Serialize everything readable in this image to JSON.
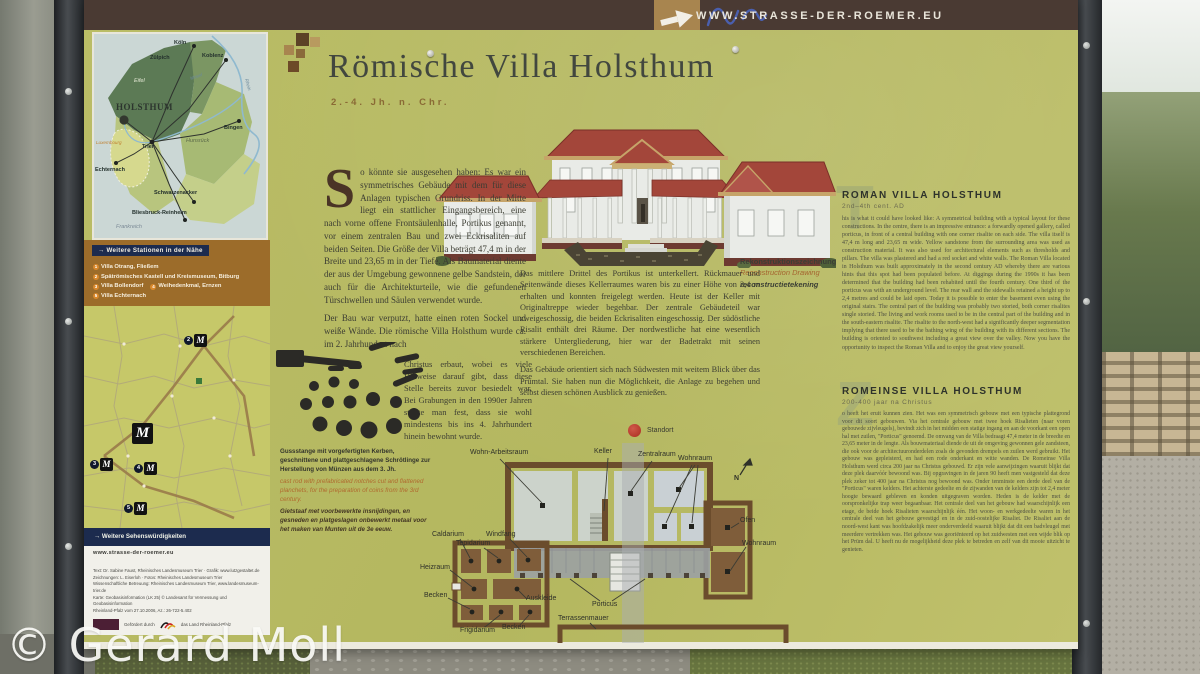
{
  "photo": {
    "watermark": "© Gerard Moll"
  },
  "colors": {
    "board_olive": "#b7ba63",
    "topbar_brown": "#4a3a33",
    "stations_brown": "#9c6c2a",
    "navy": "#1c2b4e",
    "roof_red": "#a3463a",
    "standort_red": "#bf3a2a"
  },
  "topbar": {
    "url": "WWW.STRASSE-DER-ROEMER.EU"
  },
  "header": {
    "title": "Römische Villa Holsthum",
    "subtitle": "2.-4. Jh. n. Chr."
  },
  "overview_map": {
    "holsthum": "HOLSTHUM",
    "cities": [
      {
        "label": "Köln"
      },
      {
        "label": "Zülpich"
      },
      {
        "label": "Koblenz"
      },
      {
        "label": "Bingen"
      },
      {
        "label": "Trier"
      },
      {
        "label": "Echternach"
      },
      {
        "label": "Schwarzenacker"
      },
      {
        "label": "Bliesbruck-Reinheim"
      }
    ],
    "regions": {
      "eifel": "Eifel",
      "hunsrueck": "Hunsrück",
      "frankreich": "Frankreich",
      "luxemburg": "Luxembourg",
      "mosel": "Mosel",
      "rhein": "Rhein"
    }
  },
  "stations": {
    "heading": "→ Weitere Stationen in der Nähe",
    "items": [
      {
        "num": "1",
        "label": "Villa Otrang, Fließem"
      },
      {
        "num": "2",
        "label": "Spätrömisches Kastell und Kreismuseum, Bitburg"
      },
      {
        "num": "3",
        "label": "Villa Bollendorf"
      },
      {
        "num": "4",
        "label": "Weihedenkmal, Ernzen"
      },
      {
        "num": "5",
        "label": "Villa Echternach"
      }
    ]
  },
  "sights": {
    "heading": "→ Weitere Sehenswürdigkeiten"
  },
  "credits": {
    "url": "www.strasse-der-roemer.eu",
    "lines": [
      "Text: Dr. Sabine Faust, Rheinisches Landesmuseum Trier · Grafik: www.lutzgestaltet.de",
      "Zeichnungen: L. Eiserloh · Fotos: Rheinisches Landesmuseum Trier",
      "Wissenschaftliche Betreuung: Rheinisches Landesmuseum Trier, www.landesmuseum-trier.de",
      "Karte: Geobasisinformation (LK 25) © Landesamt für Vermessung und Geobasisinformation",
      "Rheinland-Pfalz vom 27.10.2006, Az.: 26-722-5.402"
    ],
    "funding_label": "Gefördert durch",
    "funding_name": "das Land Rheinland-Pfalz"
  },
  "german": {
    "dropcap": "S",
    "para1": "o könnte sie ausgesehen haben: Es war ein symmetrisches Gebäude mit dem für diese Anlagen typischen Grundriss. In der Mitte liegt ein stattlicher Eingangsbereich, eine nach vorne offene Frontsäulenhalle, Portikus genannt, vor einem zentralen Bau und zwei Eckrisaliten auf beiden Seiten. Die Größe der Villa beträgt 47,4 m in der Breite und 23,65 m in der Tiefe. Als Baumaterial diente der aus der Umgebung gewonnene gelbe Sandstein, der auch für die Architekturteile, wie die gefundenen Türschwellen und Säulen verwendet wurde.",
    "para2": "Der Bau war verputzt, hatte einen roten Sockel und weiße Wände. Die römische Villa Holsthum wurde ca. im 2. Jahrhundert nach",
    "para2b": "Christus erbaut, wobei es viele Hinweise darauf gibt, dass diese Stelle bereits zuvor besiedelt war. Bei Grabungen in den 1990er Jahren stellte man fest, dass sie wohl mindestens bis ins 4. Jahrhundert hinein bewohnt wurde."
  },
  "middle": {
    "para1": "Das mittlere Drittel des Portikus ist unterkellert. Rückmauer und Seitenwände dieses Kellerraumes waren bis zu einer Höhe von 2,4 m erhalten und konnten freigelegt werden. Heute ist der Keller mit Originaltreppe wieder begehbar. Der zentrale Gebäudeteil war zweigeschossig, die beiden Eckrisaliten eingeschossig. Der südöstliche Risalit enthält drei Räume. Der nordwestliche hat eine wesentlich stärkere Untergliederung, hier war der Badetrakt mit seinen verschiedenen Bereichen.",
    "para2": "Das Gebäude orientiert sich nach Südwesten mit weitem Blick über das Prümtal. Sie haben nun die Möglichkeit, die Anlage zu begehen und selbst diesen schönen Ausblick zu genießen."
  },
  "reconstruction_caption": {
    "de": "Rekonstruktionszeichnung",
    "en": "Reconstruction Drawing",
    "nl": "reconstructietekening"
  },
  "artifact_caption": {
    "de": "Gussstange mit vorgefertigten Kerben, geschnittene und plattgeschlagene Schrötlinge zur Herstellung von Münzen aus dem 3. Jh.",
    "en": "cast rod with prefabricated notches cut and flattened planchets, for the preparation of coins from the 3rd century.",
    "nl": "Gietstaaf met voorbewerkte insnijdingen, en gesneden en platgeslagen onbewerkt metaal voor het maken van Munten uit de 3e eeuw."
  },
  "english": {
    "heading": "ROMAN VILLA HOLSTHUM",
    "subheading": "2nd–4th cent. AD",
    "dropcap": "T",
    "body": "his is what it could have looked like: A symmetrical building with a typical layout for these constructions. In the centre, there is an impressive entrance: a forwardly opened gallery, called porticus, in front of a central building with one corner risalite on each side. The villa itself is 47,4 m long and 23,65 m wide. Yellow sandstone from the surrounding area was used as construction material. It was also used for architectural elements such as thresholds and pillars. The villa was plastered and had a red socket and white walls. The Roman Villa located in Holsthum was built approximately in the second century AD whereby there are various hints that this spot had been populated before. At diggings during the 1990s it has been determined that the building had been rehabited until the fourth century. One third of the porticus was with an underground level. The rear wall and the sidewalls retained a height up to 2,4 metres and could be laid open. Today it is possible to enter the basement even using the original stairs. The central part of the building was probably two storied, both corner risalites single storied. The living and work rooms used to be in the central part of the building and in the south-eastern risalite. The risalite to the north-west had a significantly deeper segmentation implying that there used to be the bathing wing of the building with its different sections. The building is oriented to southwest including a great view over the valley. Now you have the opportunity to inspect the Roman Villa and to enjoy the great view yourself."
  },
  "dutch": {
    "heading": "ROMEINSE VILLA HOLSTHUM",
    "subheading": "200-400 jaar na Christus",
    "dropcap": "Z",
    "body": "o heeft het eruit kunnen zien. Het was een symmetrisch gebouw met een typische plattegrond voor dit soort gebouwen. Via het centrale gebouw met twee hoek Risalieten (naar voren gebouwde zijvleugels), bevindt zich in het midden een statige ingang en aan de voorkant een open hal met zuilen, \"Porticus\" genoemd. De omvang van de Villa bedraagt 47,4 meter in de breedte en 23,65 meter in de lengte. Als bouwmateriaal diende de uit de omgeving gewonnen gele zandsteen, die ook voor de architectuuronderdelen zoals de gevonden drempels en zuilen werd gebruikt. Het gebouw was gepleisterd, en had een rode onderkant en witte wanden. De Romeinse Villa Holsthum werd circa 200 jaar na Christus gebouwd. Er zijn vele aanwijzingen waaruit blijkt dat deze plek daarvóór bewoond was. Bij opgravingen in de jaren 90 heeft men vastgesteld dat deze plek zeker tot 400 jaar na Christus nog bewoond was. Onder tenminste een derde deel van de \"Porticus\" waren kelders. Het achterste gedeelte en de zijwanden van de kelders zijn tot 2,4 meter hoogte bewaard gebleven en konden uitgegraven worden. Heden is de kelder met de oorspronkelijke trap weer begaanbaar. Het centrale deel van het gebouw had waarschijnlijk een etage, de beide hoek Risalieten waarschijnlijk één. Het woon- en werkgedeelte waren in het centrale deel van het gebouw gevestigd en in de zuid-oostelijke Risaliet. De Risaliet aan de noord-west kant was hoofdzakelijk meer onderverdeeld waaruit blijkt dat dit een badvleugel met meerdere vertrekken was. Het gebouw was georiënteerd op het zuidwesten met een wijde blik op het Prüm dal. U heeft nu de mogelijkheid deze plek te betreden en zelf van dit mooie uitzicht te genieten."
  },
  "floorplan": {
    "standort": "Standort",
    "labels": {
      "wohn_arbeitsraum": "Wohn-Arbeitsraum",
      "keller": "Keller",
      "zentralraum": "Zentralraum",
      "wohnraum": "Wohnraum",
      "ofen": "Ofen",
      "wohnraum2": "Wohnraum",
      "caldarium": "Caldarium",
      "tepidarium": "Tepidarium",
      "windfang": "Windfang",
      "heizraum": "Heizraum",
      "becken": "Becken",
      "frigidarium": "Frigidarium",
      "becken2": "Becken",
      "auskleide": "Auskleide",
      "porticus": "Porticus",
      "terrassenmauer": "Terrassenmauer",
      "north": "N"
    }
  }
}
